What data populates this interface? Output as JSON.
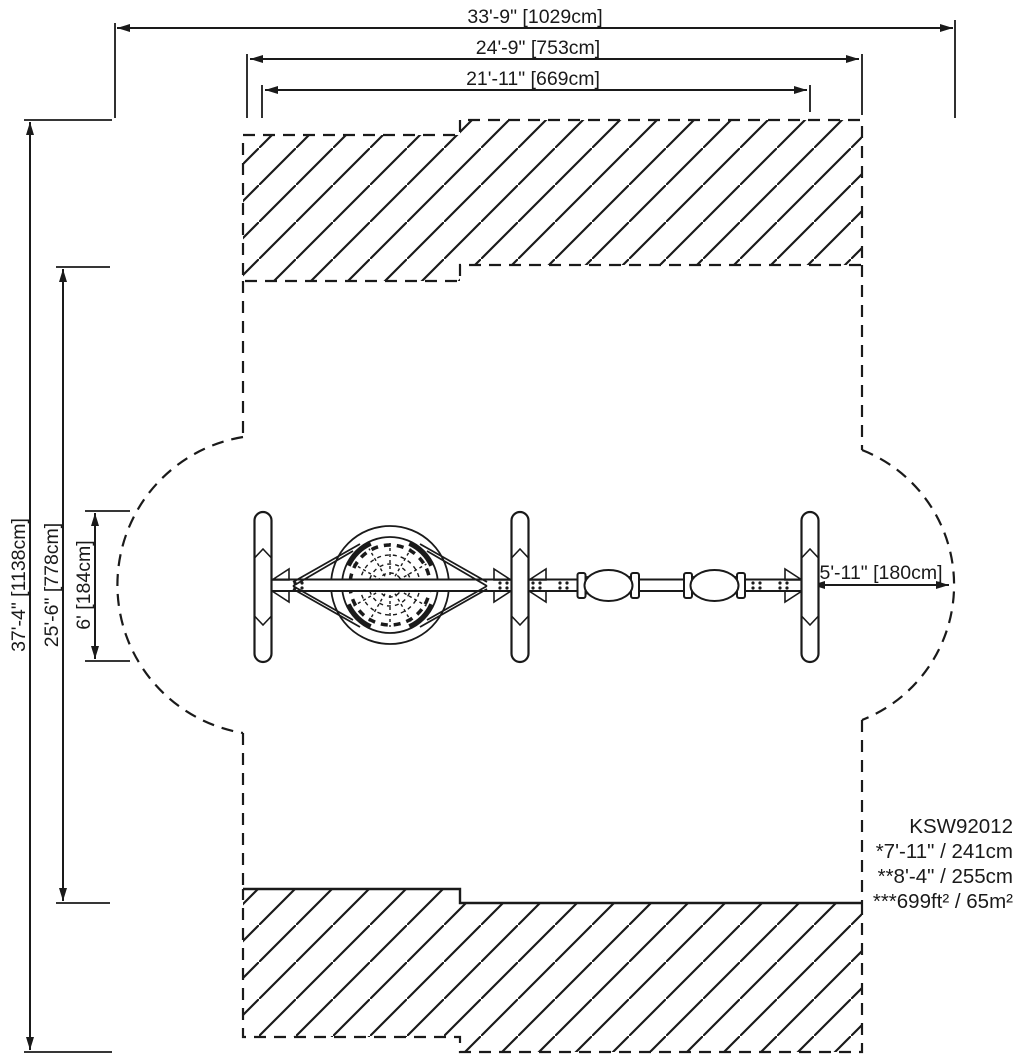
{
  "labels": {
    "dim_total_width": "33'-9\" [1029cm]",
    "dim_use_zone_width": "24'-9\" [753cm]",
    "dim_frame_width": "21'-11\" [669cm]",
    "dim_total_height": "37'-4\" [1138cm]",
    "dim_use_zone_height": "25'-6\" [778cm]",
    "dim_frame_depth": "6' [184cm]",
    "dim_side_clearance": "5'-11\" [180cm]"
  },
  "notes": {
    "model": "KSW92012",
    "line1": "*7'-11\" / 241cm",
    "line2": "**8'-4\" / 255cm",
    "line3": "***699ft² / 65m²"
  },
  "colors": {
    "ink": "#1a1a1a",
    "background": "#ffffff"
  }
}
